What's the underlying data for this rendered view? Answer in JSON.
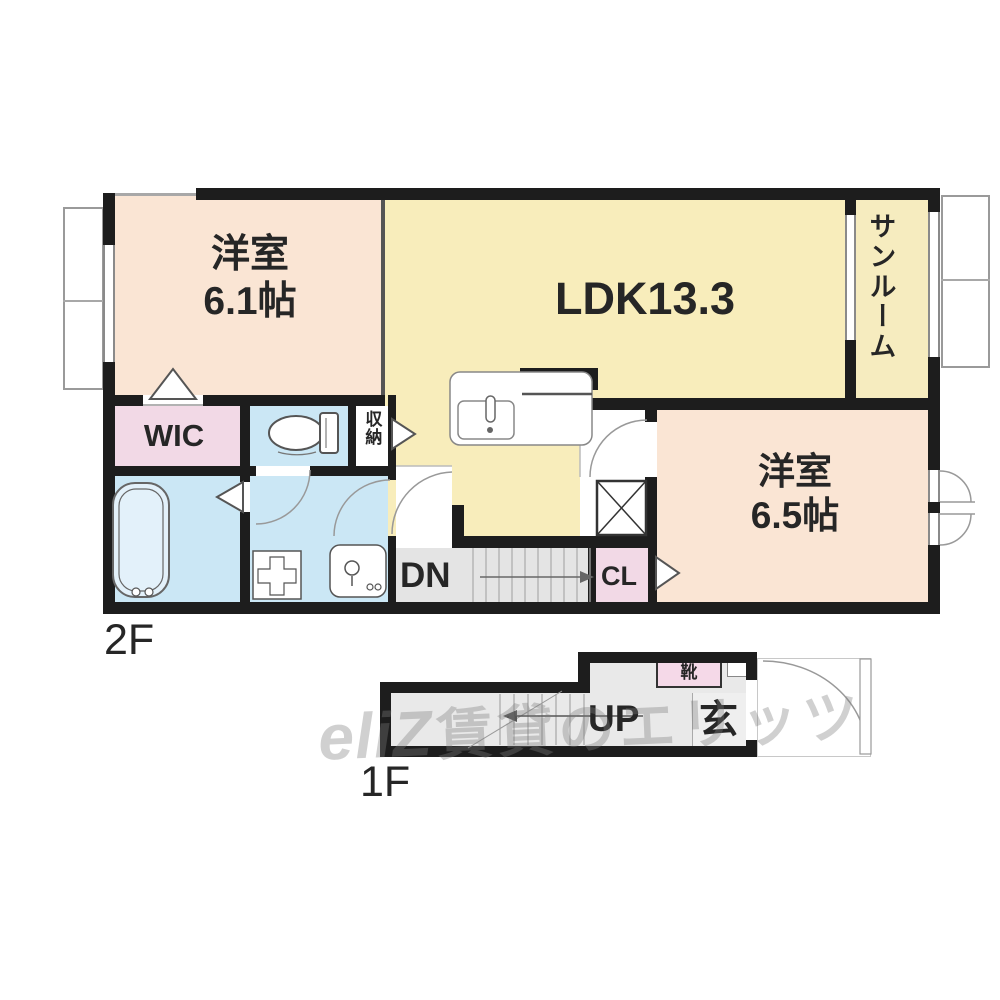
{
  "floorplan": {
    "floor_2f": {
      "label": "2F"
    },
    "floor_1f": {
      "label": "1F"
    },
    "rooms": {
      "western_room_61": {
        "name": "洋室",
        "size": "6.1帖"
      },
      "ldk": {
        "label": "LDK13.3"
      },
      "sunroom": {
        "label": "サンルーム"
      },
      "wic": {
        "label": "WIC"
      },
      "storage": {
        "label": "収納"
      },
      "western_room_65": {
        "name": "洋室",
        "size": "6.5帖"
      },
      "stairs_down": {
        "label": "DN"
      },
      "closet": {
        "label": "CL"
      },
      "stairs_up": {
        "label": "UP"
      },
      "entrance": {
        "label": "玄"
      },
      "shoe_cabinet": {
        "label": "靴"
      }
    },
    "watermark": {
      "logo": "eliZ",
      "text": "賃貸のエリッツ"
    },
    "colors": {
      "wall": "#1d1d1d",
      "western_room": "#fae5d4",
      "ldk": "#f8edbb",
      "sunroom": "#f6ecbf",
      "closet_pink": "#f2d9e6",
      "wet_area_blue": "#cbe7f5",
      "stairs_gray": "#e4e4e4"
    }
  }
}
